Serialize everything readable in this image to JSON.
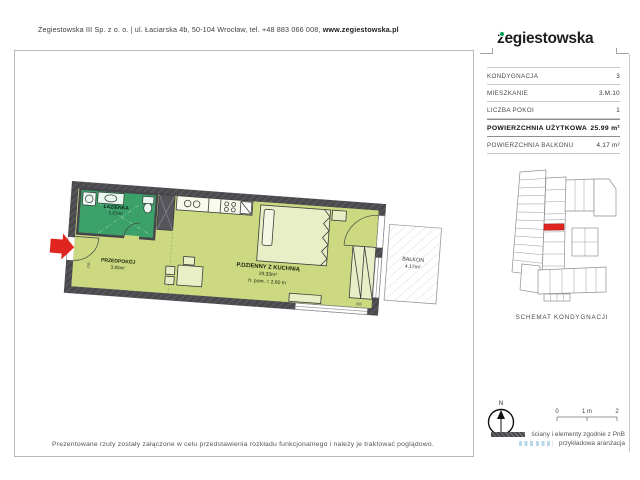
{
  "page": {
    "header": {
      "text": "Żegiestowska III Sp. z o. o. | ul. Łaciarska 4b, 50-104 Wrocław, tel. +48 883 066 008,",
      "link": "www.zegiestowska.pl"
    },
    "footer_note": "Prezentowane rzuty zostały załączone w celu przedstawienia rozkładu funkcjonalnego i należy je traktować poglądowo."
  },
  "brand": {
    "name": "żegiestowska",
    "accent_color": "#009e54"
  },
  "info_table": {
    "rows": [
      {
        "label": "KONDYGNACJA",
        "value": "3"
      },
      {
        "label": "MIESZKANIE",
        "value": "3.M.10"
      },
      {
        "label": "LICZBA POKOI",
        "value": "1"
      },
      {
        "label": "POWIERZCHNIA UŻYTKOWA",
        "value": "25.99 m²"
      },
      {
        "label": "POWIERZCHNIA BALKONU",
        "value": "4.17 m²"
      }
    ]
  },
  "floor_plan": {
    "rooms": [
      {
        "name": "ŁAZIENKA",
        "area": "2.83m²"
      },
      {
        "name": "PRZEDPOKÓJ",
        "area": "3.83m²"
      },
      {
        "name": "P.DZIENNY Z KUCHNIĄ",
        "area": "19.33m²",
        "height_note": "h. pom. = 2.60 m"
      },
      {
        "name": "BALKON",
        "area": "4.17m²"
      }
    ],
    "dims": {
      "d1": "250",
      "d2": "805"
    },
    "colors": {
      "walls": "#4a4a4e",
      "bathroom": "#3ba169",
      "living": "#ccd980",
      "entrance_arrow": "#e02520"
    }
  },
  "key_plan": {
    "caption": "SCHEMAT KONDYGNACJI",
    "highlighted_unit": "3.M.10",
    "highlight_color": "#e02520"
  },
  "compass": {
    "north": "N"
  },
  "scale_bar": {
    "t0": "0",
    "t1": "1 m",
    "t2": "2"
  },
  "legend": {
    "walls": "ściany i elementy zgodnie z PnB",
    "furnishing": "przykładowa aranżacja"
  }
}
